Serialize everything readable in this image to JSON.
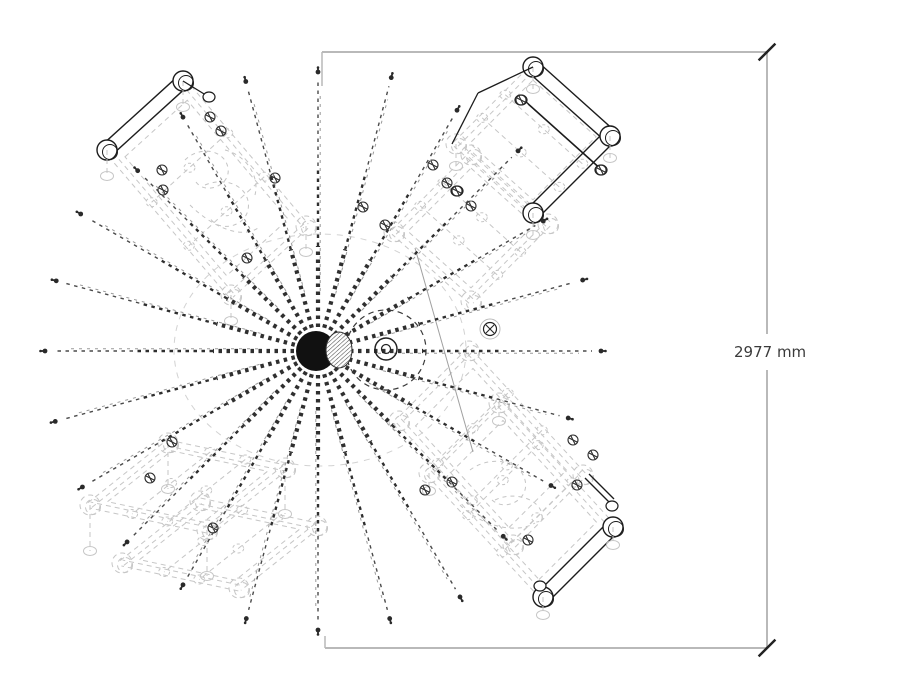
{
  "scene": {
    "background": "#ffffff",
    "style": {
      "hidden_color": "#c6c6c6",
      "hidden_dash": "5 4",
      "dark_color": "#1c1c1c",
      "ray_color": "#2f2f2f",
      "ray_far_color": "#4a4a4a",
      "ray_ghost_color": "#9a9a9a",
      "dim_line_color": "#b9b9b9",
      "dim_tick_color": "#222222",
      "dim_text_color": "#3b3b3b"
    }
  },
  "dimension": {
    "label": "2977 mm",
    "top_line": {
      "x1": 322,
      "y1": 52,
      "x2": 767,
      "y2": 52,
      "stub_len": 34
    },
    "bottom_line": {
      "x1": 325,
      "y1": 648,
      "x2": 767,
      "y2": 648,
      "stub_len": 12
    },
    "right_line": {
      "x": 767,
      "y1": 52,
      "y2": 648,
      "gap_top": 334,
      "gap_bottom": 370
    },
    "ticks": [
      [
        767,
        52
      ],
      [
        767,
        648
      ]
    ],
    "tick_len": 24
  },
  "light": {
    "center": [
      318,
      351
    ],
    "sphere": {
      "cx": 316,
      "cy": 351,
      "r": 20
    },
    "hatch_ellipse": {
      "cx": 339,
      "cy": 350,
      "rx": 13,
      "ry": 18
    },
    "bulb_ring": {
      "cx": 386,
      "cy": 349,
      "r_outer": 11,
      "r_inner": 4.5
    },
    "dash_circle": {
      "cx": 386,
      "cy": 350,
      "r": 40
    },
    "ambient_ellipse": {
      "cx": 320,
      "cy": 350,
      "rx": 146,
      "ry": 116
    },
    "joint_ball": {
      "cx": 490,
      "cy": 329,
      "r": 6.5
    },
    "extra_line": [
      415,
      248,
      473,
      452
    ],
    "rays": [
      {
        "angle": 0,
        "length": 283
      },
      {
        "angle": 15,
        "length": 274
      },
      {
        "angle": 30,
        "length": 260
      },
      {
        "angle": 45,
        "length": 283
      },
      {
        "angle": 60,
        "length": 278
      },
      {
        "angle": 75,
        "length": 283
      },
      {
        "angle": 90,
        "length": 279
      },
      {
        "angle": 105,
        "length": 279
      },
      {
        "angle": 120,
        "length": 270
      },
      {
        "angle": 135,
        "length": 255
      },
      {
        "angle": 150,
        "length": 274
      },
      {
        "angle": 165,
        "length": 271
      },
      {
        "angle": 180,
        "length": 273
      },
      {
        "angle": 195,
        "length": 272
      },
      {
        "angle": 210,
        "length": 272
      },
      {
        "angle": 225,
        "length": 270
      },
      {
        "angle": 240,
        "length": 270
      },
      {
        "angle": 255,
        "length": 277
      },
      {
        "angle": 270,
        "length": 279
      },
      {
        "angle": 285,
        "length": 277
      },
      {
        "angle": 300,
        "length": 284
      },
      {
        "angle": 315,
        "length": 262
      },
      {
        "angle": 330,
        "length": 269
      },
      {
        "angle": 345,
        "length": 259
      }
    ]
  },
  "furniture": [
    {
      "id": "frame-top-left",
      "corners": [
        [
          107,
          150
        ],
        [
          183,
          81
        ],
        [
          306,
          226
        ],
        [
          231,
          295
        ]
      ],
      "solid_sides": [
        0
      ],
      "leg_len": 26,
      "ghost_offset": null,
      "joints": [
        [
          210,
          117
        ],
        [
          221,
          131
        ],
        [
          162,
          170
        ],
        [
          275,
          178
        ],
        [
          163,
          190
        ],
        [
          247,
          258
        ]
      ],
      "squiggles": [
        "M185,160 C200,145 225,150 228,168 C231,186 205,195 196,182",
        "M205,185 C230,175 252,190 248,210 C244,228 218,232 210,218",
        "M190,205 C210,225 240,240 258,228",
        "M225,150 C245,155 260,175 255,195"
      ],
      "extra_solid": [
        [
          183,
          81,
          209,
          97
        ]
      ],
      "extra_ellipses": [
        [
          209,
          97
        ]
      ]
    },
    {
      "id": "frame-top-right",
      "corners": [
        [
          533,
          67
        ],
        [
          610,
          136
        ],
        [
          533,
          213
        ],
        [
          456,
          144
        ]
      ],
      "solid_sides": [
        0,
        1
      ],
      "leg_len": 22,
      "ghost_offset": [
        -62,
        88
      ],
      "joints": [
        [
          363,
          207
        ],
        [
          385,
          225
        ],
        [
          433,
          165
        ],
        [
          447,
          183
        ],
        [
          521,
          100
        ],
        [
          601,
          170
        ],
        [
          457,
          191
        ],
        [
          471,
          206
        ]
      ],
      "squiggles": [],
      "extra_solid": [
        [
          524,
          100,
          601,
          169
        ],
        [
          528,
          104,
          605,
          173
        ],
        [
          478,
          93,
          533,
          67
        ],
        [
          452,
          144,
          478,
          93
        ]
      ],
      "extra_ellipses": [
        [
          521,
          100
        ],
        [
          601,
          170
        ],
        [
          457,
          191
        ]
      ]
    },
    {
      "id": "frame-bottom-right",
      "corners": [
        [
          543,
          597
        ],
        [
          613,
          527
        ],
        [
          499,
          403
        ],
        [
          429,
          473
        ]
      ],
      "solid_sides": [
        0
      ],
      "leg_len": 18,
      "ghost_offset": [
        -30,
        -52
      ],
      "joints": [
        [
          452,
          482
        ],
        [
          577,
          485
        ],
        [
          528,
          540
        ],
        [
          573,
          440
        ],
        [
          593,
          455
        ],
        [
          425,
          490
        ]
      ],
      "squiggles": [
        "M470,470 C490,455 520,460 525,480 C530,500 505,512 492,500",
        "M495,500 C515,490 545,500 542,520",
        "M460,505 C480,525 515,535 535,523"
      ],
      "extra_solid": [
        [
          585,
          478,
          610,
          503
        ],
        [
          589,
          474,
          614,
          499
        ]
      ],
      "extra_ellipses": [
        [
          612,
          506
        ],
        [
          540,
          586
        ]
      ]
    },
    {
      "id": "frame-bottom-left",
      "corners": [
        [
          90,
          505
        ],
        [
          168,
          443
        ],
        [
          285,
          468
        ],
        [
          207,
          530
        ]
      ],
      "solid_sides": [],
      "leg_len": 46,
      "ghost_offset": [
        32,
        58
      ],
      "joints": [
        [
          150,
          478
        ],
        [
          172,
          442
        ],
        [
          213,
          528
        ]
      ],
      "squiggles": [],
      "extra_solid": [],
      "extra_ellipses": []
    }
  ]
}
